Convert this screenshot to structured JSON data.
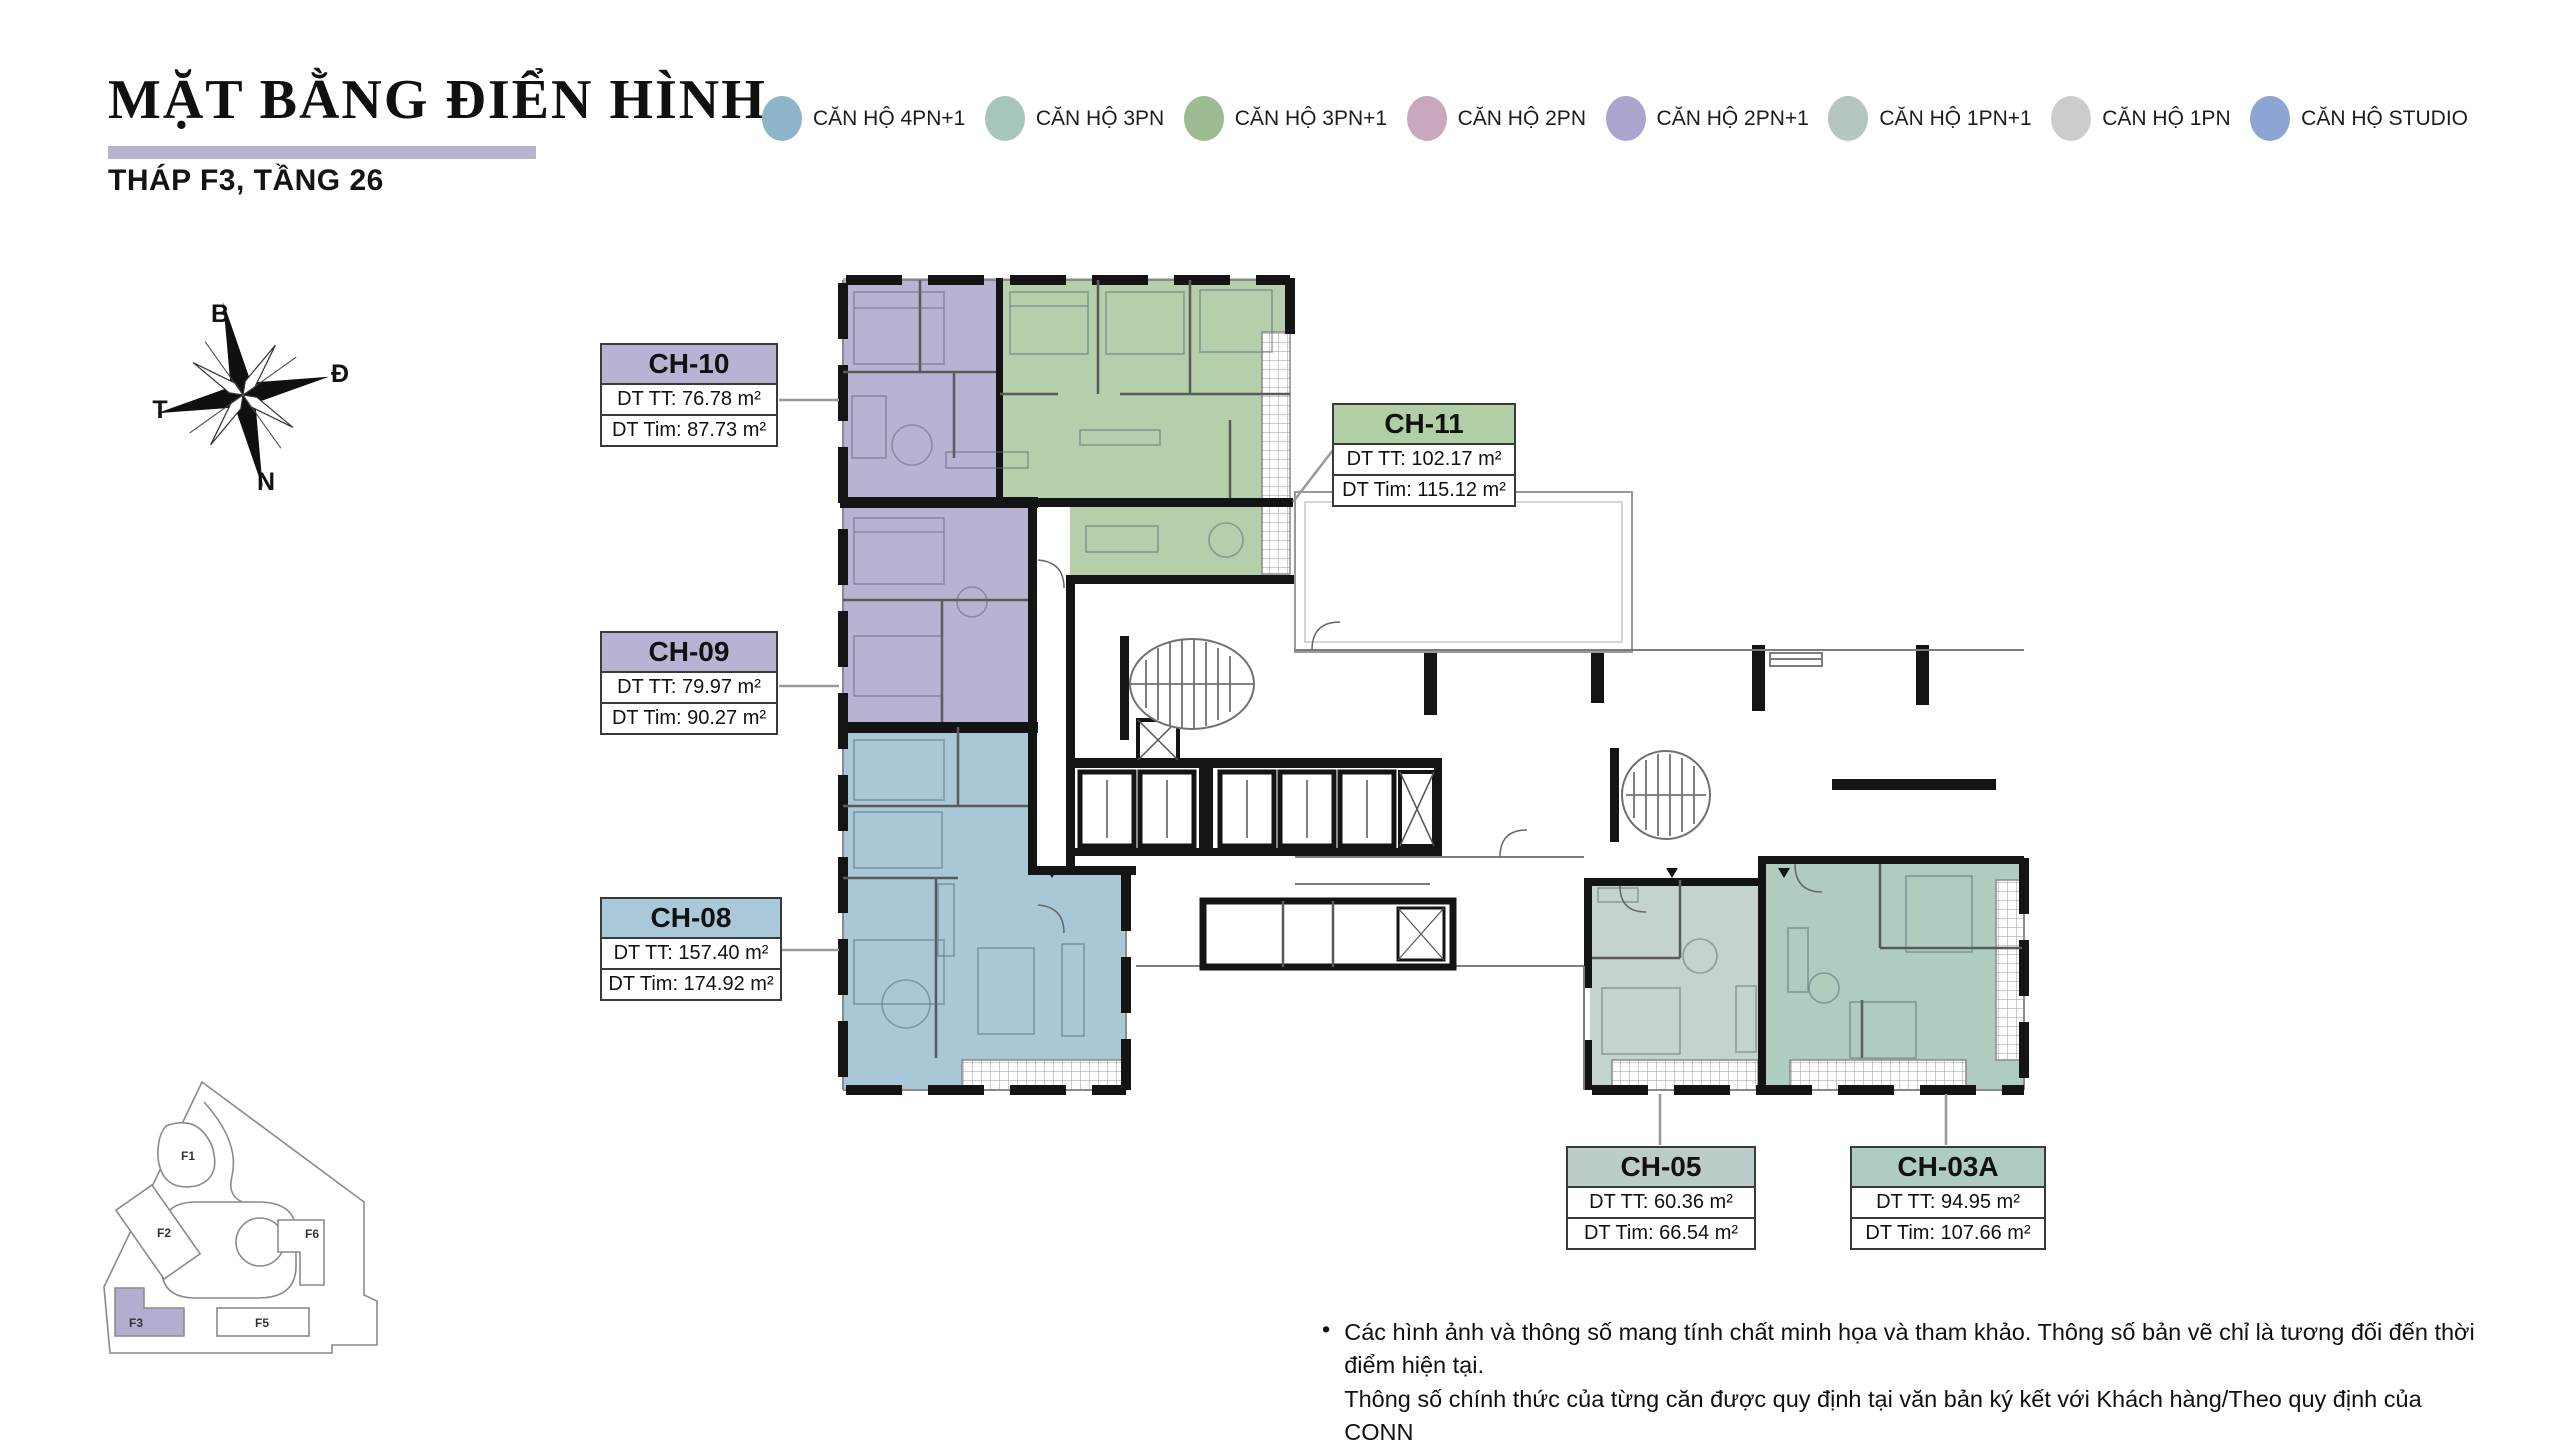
{
  "header": {
    "title": "MẶT BẰNG ĐIỂN HÌNH",
    "subtitle": "THÁP F3, TẦNG 26",
    "underline_color": "#b7b4cf"
  },
  "legend": {
    "items": [
      {
        "label": "CĂN HỘ 4PN+1",
        "color": "#8eb4c9"
      },
      {
        "label": "CĂN HỘ 3PN",
        "color": "#a6c6ba"
      },
      {
        "label": "CĂN HỘ 3PN+1",
        "color": "#9dbb90"
      },
      {
        "label": "CĂN HỘ 2PN",
        "color": "#c9a7bc"
      },
      {
        "label": "CĂN HỘ 2PN+1",
        "color": "#a9a5ce"
      },
      {
        "label": "CĂN HỘ 1PN+1",
        "color": "#b5c5c4"
      },
      {
        "label": "CĂN HỘ 1PN",
        "color": "#ccccca"
      },
      {
        "label": "CĂN HỘ STUDIO",
        "color": "#8ca5d5"
      }
    ]
  },
  "compass": {
    "north": "B",
    "east": "Đ",
    "south": "N",
    "west": "T"
  },
  "unit_labels": [
    {
      "id": "CH-10",
      "line1": "DT TT: 76.78 m²",
      "line2": "DT Tim: 87.73 m²",
      "header_color": "#b8b3d3"
    },
    {
      "id": "CH-11",
      "line1": "DT TT: 102.17 m²",
      "line2": "DT Tim: 115.12 m²",
      "header_color": "#b0cfa4"
    },
    {
      "id": "CH-09",
      "line1": "DT TT: 79.97 m²",
      "line2": "DT Tim: 90.27 m²",
      "header_color": "#b8b3d3"
    },
    {
      "id": "CH-08",
      "line1": "DT TT: 157.40 m²",
      "line2": "DT Tim: 174.92 m²",
      "header_color": "#a9c9da"
    },
    {
      "id": "CH-05",
      "line1": "DT TT: 60.36 m²",
      "line2": "DT Tim: 66.54 m²",
      "header_color": "#bccccb"
    },
    {
      "id": "CH-03A",
      "line1": "DT TT: 94.95 m²",
      "line2": "DT Tim: 107.66 m²",
      "header_color": "#aecdbf"
    }
  ],
  "site_plan": {
    "buildings": [
      "F1",
      "F2",
      "F3",
      "F5",
      "F6"
    ],
    "highlighted": "F3",
    "highlight_color": "#b3aed0"
  },
  "footnote": {
    "bullet": "•",
    "line1": "Các hình ảnh và thông số mang tính chất minh họa và tham khảo. Thông số bản vẽ chỉ là tương đối đến thời điểm hiện tại.",
    "line2": "Thông số chính thức của từng căn được quy định tại văn bản ký kết với Khách hàng/Theo quy định của CQNN"
  },
  "colors": {
    "purple": "#b8b3d3",
    "green": "#b4cfaa",
    "blue": "#a8c8d8",
    "teal": "#aecdbf",
    "gray_teal": "#c4d2d0"
  }
}
